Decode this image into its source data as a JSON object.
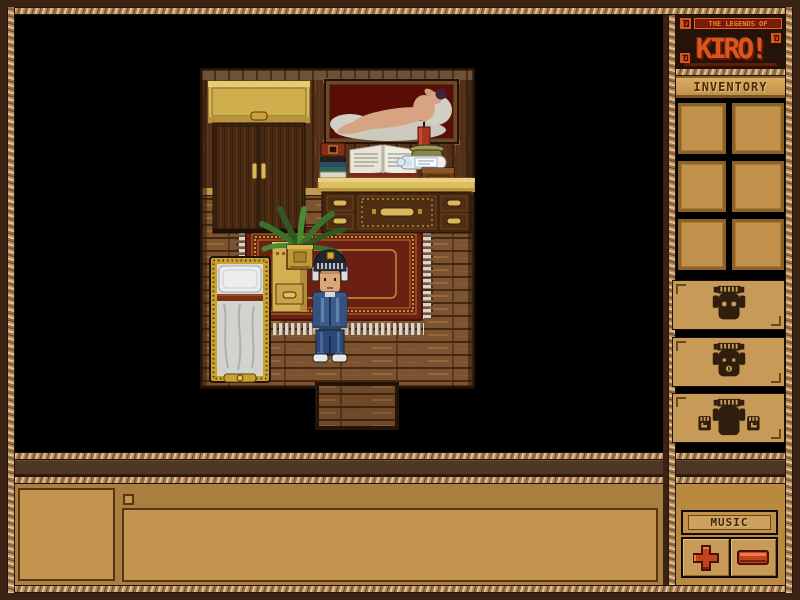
{
  "window": {
    "title_tagline": "THE LEGENDS OF",
    "title": "KIRO!"
  },
  "sidebar": {
    "inventory_label": "INVENTORY",
    "slots": [
      {
        "index": 1,
        "state": "empty"
      },
      {
        "index": 2,
        "state": "empty"
      },
      {
        "index": 3,
        "state": "empty"
      },
      {
        "index": 4,
        "state": "empty"
      },
      {
        "index": 5,
        "state": "empty"
      },
      {
        "index": 6,
        "state": "empty"
      }
    ],
    "emote_buttons": [
      {
        "icon": "tiki-mask-eyes-icon"
      },
      {
        "icon": "tiki-mask-mouth-icon"
      },
      {
        "icon": "tiki-mask-hands-icon"
      }
    ],
    "music": {
      "label": "MUSIC",
      "icons": [
        "volume-plus-icon",
        "volume-minus-icon"
      ]
    }
  },
  "chat": {
    "input_value": ""
  },
  "scene": {
    "location": "bedroom-interior",
    "objects": [
      "wardrobe",
      "framed-nude-painting",
      "stacked-books",
      "open-book",
      "candle",
      "message-bottle",
      "wooden-box",
      "dresser-desk",
      "potted-fern",
      "nightstand",
      "bed",
      "red-rug",
      "player-character",
      "doorway-step"
    ],
    "icons": [
      "spiral-ornament-icon"
    ]
  },
  "colors": {
    "frame": "#3a2315",
    "rope": "#b58c5e",
    "panel": "#a87f3e",
    "slot": "#c2924c",
    "accent_orange": "#d9571d",
    "button_red": "#c0451c",
    "viewport_bg": "#000000"
  }
}
